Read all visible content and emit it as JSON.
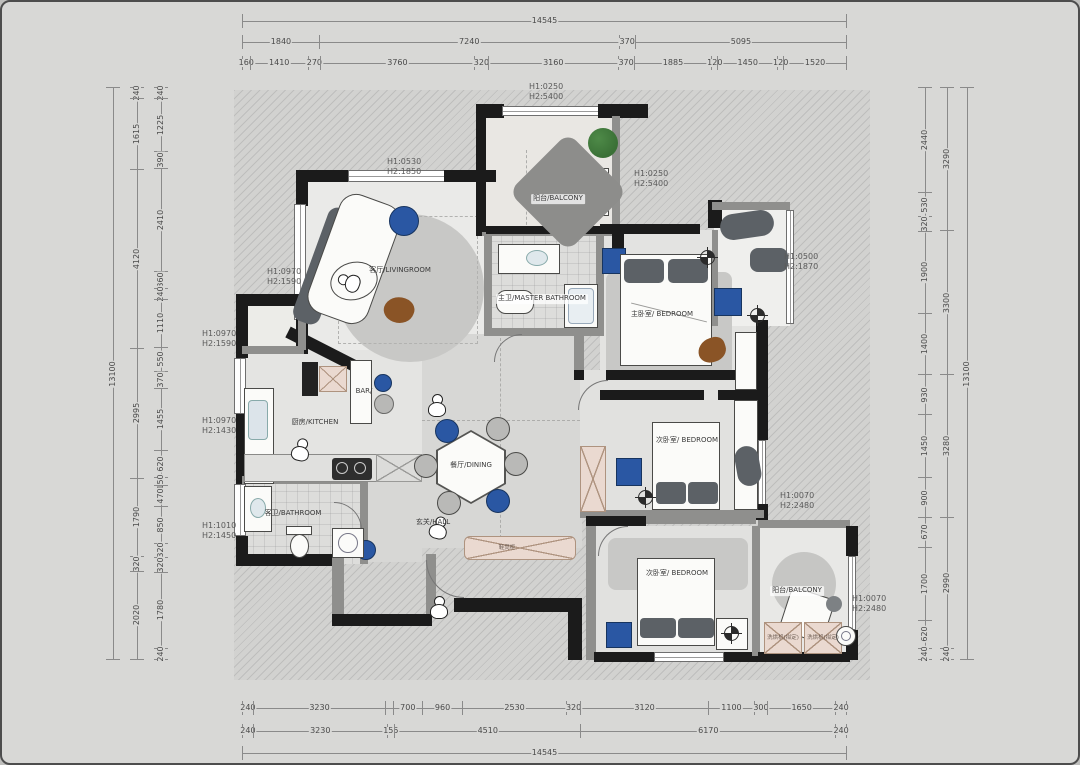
{
  "colors": {
    "page": "#d8d8d6",
    "hatch_bg": "#d2d2d0",
    "hatch_line": "rgba(120,120,120,0.22)",
    "wall": "#1b1b1b",
    "gwall": "#8f8f8d",
    "rug": "#c8c8c6",
    "accent_blue": "#2a57a3",
    "accent_blue_dark": "#17345f",
    "furn_dark": "#5c6166",
    "pink": "#ead9d0",
    "pink_line": "#ae937f",
    "green": "#3a7036",
    "brown": "#8a5426",
    "dim_line": "#8a8a8a",
    "dim_text": "#4a4a4a",
    "label_text": "#3a3a3a"
  },
  "dims": {
    "h_extent": {
      "x": 240,
      "width": 605
    },
    "v_extent": {
      "y": 85,
      "height": 573
    },
    "chains": [
      {
        "id": "top-outer",
        "orient": "h",
        "pos": 12,
        "segments": [
          {
            "v": 14545
          }
        ]
      },
      {
        "id": "top-mid",
        "orient": "h",
        "pos": 33,
        "segments": [
          {
            "v": 1840
          },
          {
            "v": 7240
          },
          {
            "v": 370
          },
          {
            "v": 5095
          }
        ]
      },
      {
        "id": "top-inner",
        "orient": "h",
        "pos": 54,
        "segments": [
          {
            "v": 160
          },
          {
            "v": 1410
          },
          {
            "v": 270
          },
          {
            "v": 3760
          },
          {
            "v": 320
          },
          {
            "v": 3160
          },
          {
            "v": 370
          },
          {
            "v": 1885
          },
          {
            "v": 120
          },
          {
            "v": 1450
          },
          {
            "v": 120
          },
          {
            "v": 1520
          }
        ]
      },
      {
        "id": "bottom-inner",
        "orient": "h",
        "pos": 699,
        "segments": [
          {
            "v": 240
          },
          {
            "v": 3230
          },
          {
            "v": 155,
            "label": ""
          },
          {
            "v": 700
          },
          {
            "v": 960
          },
          {
            "v": 2530
          },
          {
            "v": 320
          },
          {
            "v": 3120
          },
          {
            "v": 1100
          },
          {
            "v": 300
          },
          {
            "v": 1650
          },
          {
            "v": 240
          }
        ]
      },
      {
        "id": "bottom-mid",
        "orient": "h",
        "pos": 722,
        "segments": [
          {
            "v": 240
          },
          {
            "v": 3230
          },
          {
            "v": 155
          },
          {
            "v": 4510
          },
          {
            "v": 6170
          },
          {
            "v": 240
          }
        ]
      },
      {
        "id": "bottom-outer",
        "orient": "h",
        "pos": 744,
        "segments": [
          {
            "v": 14545
          }
        ]
      },
      {
        "id": "left-outer",
        "orient": "v",
        "pos": 104,
        "segments": [
          {
            "v": 13100
          }
        ]
      },
      {
        "id": "left-mid",
        "orient": "v",
        "pos": 128,
        "segments": [
          {
            "v": 240
          },
          {
            "v": 1615
          },
          {
            "v": 4120
          },
          {
            "v": 2995
          },
          {
            "v": 1790
          },
          {
            "v": 320
          },
          {
            "v": 2020
          }
        ]
      },
      {
        "id": "left-inner",
        "orient": "v",
        "pos": 152,
        "segments": [
          {
            "v": 240
          },
          {
            "v": 1225
          },
          {
            "v": 390
          },
          {
            "v": 2410
          },
          {
            "v": 360
          },
          {
            "v": 240
          },
          {
            "v": 1110
          },
          {
            "v": 550
          },
          {
            "v": 370
          },
          {
            "v": 1455
          },
          {
            "v": 620
          },
          {
            "v": 150
          },
          {
            "v": 470
          },
          {
            "v": 850
          },
          {
            "v": 320
          },
          {
            "v": 320
          },
          {
            "v": 1780
          },
          {
            "v": 240
          }
        ]
      },
      {
        "id": "right-inner",
        "orient": "v",
        "pos": 916,
        "segments": [
          {
            "v": 2440
          },
          {
            "v": 530
          },
          {
            "v": 320
          },
          {
            "v": 1900
          },
          {
            "v": 1400
          },
          {
            "v": 930
          },
          {
            "v": 1450
          },
          {
            "v": 900
          },
          {
            "v": 670
          },
          {
            "v": 1700
          },
          {
            "v": 620
          },
          {
            "v": 240
          }
        ]
      },
      {
        "id": "right-mid",
        "orient": "v",
        "pos": 938,
        "segments": [
          {
            "v": 3290
          },
          {
            "v": 3300
          },
          {
            "v": 3280
          },
          {
            "v": 2990
          },
          {
            "v": 240
          }
        ]
      },
      {
        "id": "right-outer",
        "orient": "v",
        "pos": 958,
        "segments": [
          {
            "v": 13100
          }
        ]
      }
    ]
  },
  "rooms": [
    {
      "label": "客厅/LIVINGROOM",
      "x": 398,
      "y": 269,
      "chip": false
    },
    {
      "label": "阳台/BALCONY",
      "x": 556,
      "y": 197,
      "chip": true
    },
    {
      "label": "主卫/MASTER BATHROOM",
      "x": 540,
      "y": 297,
      "chip": true
    },
    {
      "label": "主卧室/ BEDROOM",
      "x": 660,
      "y": 313,
      "chip": false
    },
    {
      "label": "厨房/KITCHEN",
      "x": 313,
      "y": 421,
      "chip": false
    },
    {
      "label": "BAR/",
      "x": 362,
      "y": 390,
      "chip": false
    },
    {
      "label": "餐厅/DINING",
      "x": 469,
      "y": 464,
      "chip": false
    },
    {
      "label": "玄关/HALL",
      "x": 431,
      "y": 521,
      "chip": false
    },
    {
      "label": "客卫/BATHROOM",
      "x": 291,
      "y": 512,
      "chip": false
    },
    {
      "label": "次卧室/ BEDROOM",
      "x": 685,
      "y": 439,
      "chip": false
    },
    {
      "label": "次卧室/ BEDROOM",
      "x": 675,
      "y": 572,
      "chip": false
    },
    {
      "label": "阳台/BALCONY",
      "x": 795,
      "y": 589,
      "chip": true
    }
  ],
  "height_notes": [
    {
      "line1": "H1:0250",
      "line2": "H2:5400",
      "x": 527,
      "y": 80
    },
    {
      "line1": "H1:0250",
      "line2": "H2:5400",
      "x": 632,
      "y": 167
    },
    {
      "line1": "H1:0530",
      "line2": "H2:1850",
      "x": 385,
      "y": 155
    },
    {
      "line1": "H1:0970",
      "line2": "H2:1590",
      "x": 265,
      "y": 265
    },
    {
      "line1": "H1:0970",
      "line2": "H2:1590",
      "x": 200,
      "y": 327
    },
    {
      "line1": "H1:0970",
      "line2": "H2:1430",
      "x": 200,
      "y": 414
    },
    {
      "line1": "H1:1010",
      "line2": "H2:1450",
      "x": 200,
      "y": 519
    },
    {
      "line1": "H1:0500",
      "line2": "H2:1870",
      "x": 782,
      "y": 250
    },
    {
      "line1": "H1:0070",
      "line2": "H2:2480",
      "x": 778,
      "y": 489
    },
    {
      "line1": "H1:0070",
      "line2": "H2:2480",
      "x": 850,
      "y": 592
    }
  ],
  "furniture_labels": [
    {
      "label": "鞋凳柜",
      "x": 505,
      "y": 546
    },
    {
      "label": "洗烘机(拟定)",
      "x": 781,
      "y": 636
    },
    {
      "label": "洗烘机(拟定)",
      "x": 821,
      "y": 636
    }
  ]
}
